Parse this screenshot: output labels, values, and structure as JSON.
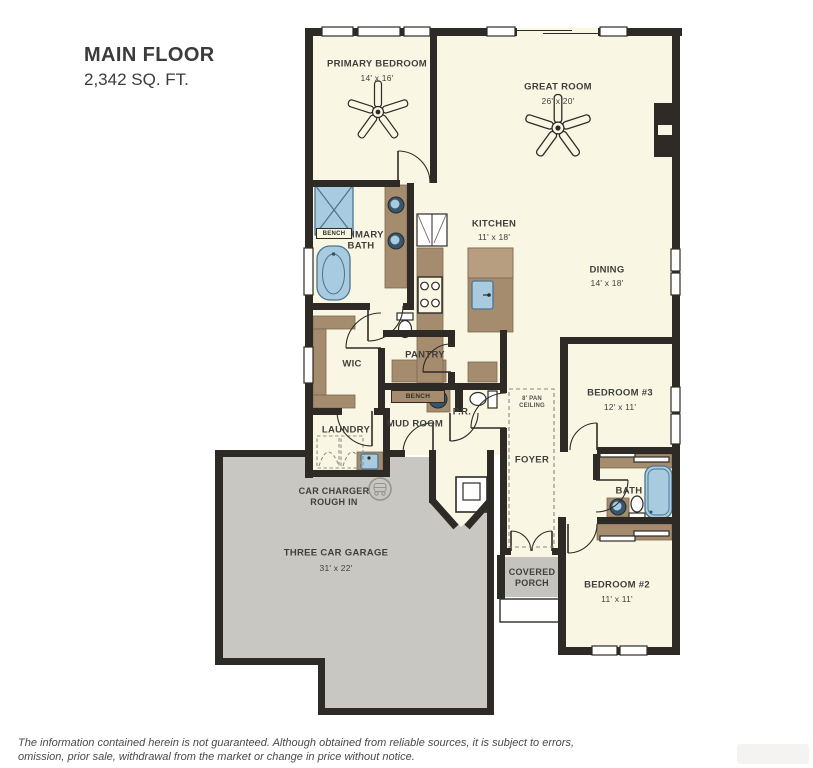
{
  "title": {
    "name": "MAIN FLOOR",
    "area": "2,342 SQ. FT."
  },
  "rooms": {
    "primary_bedroom": {
      "label": "PRIMARY BEDROOM",
      "dims": "14' x 16'"
    },
    "great_room": {
      "label": "GREAT ROOM",
      "dims": "26' x 20'"
    },
    "kitchen": {
      "label": "KITCHEN",
      "dims": "11' x 18'"
    },
    "dining": {
      "label": "DINING",
      "dims": "14' x 18'"
    },
    "primary_bath": {
      "label": "PRIMARY BATH"
    },
    "wic": {
      "label": "WIC"
    },
    "laundry": {
      "label": "LAUNDRY"
    },
    "pantry": {
      "label": "PANTRY"
    },
    "mud_room": {
      "label": "MUD ROOM"
    },
    "powder_room": {
      "label": "P.R."
    },
    "foyer": {
      "label": "FOYER",
      "ceiling_note": "8' PAN CEILING"
    },
    "bedroom_3": {
      "label": "BEDROOM #3",
      "dims": "12' x 11'"
    },
    "bath": {
      "label": "BATH"
    },
    "bedroom_2": {
      "label": "BEDROOM #2",
      "dims": "11' x 11'"
    },
    "covered_porch": {
      "label": "COVERED PORCH"
    },
    "garage": {
      "label": "THREE CAR GARAGE",
      "dims": "31' x 22'",
      "feature": "CAR CHARGER ROUGH IN"
    }
  },
  "fixtures": {
    "bench_shower": "BENCH",
    "bench_mud": "BENCH"
  },
  "disclaimer": {
    "line1": "The information contained herein is not guaranteed. Although obtained from reliable sources, it is subject to errors,",
    "line2": "omission, prior sale, withdrawal from the market or change in price without notice."
  },
  "colors": {
    "floor": "#f9f7e4",
    "wall": "#2e2a26",
    "cabinet": "#a68c6f",
    "cabinet_light": "#b89e81",
    "garage": "#c9c7c2",
    "porch": "#c5c3bd",
    "fixture": "#a9cbdf",
    "fixture_dark": "#4a758f",
    "text": "#403f3b"
  }
}
